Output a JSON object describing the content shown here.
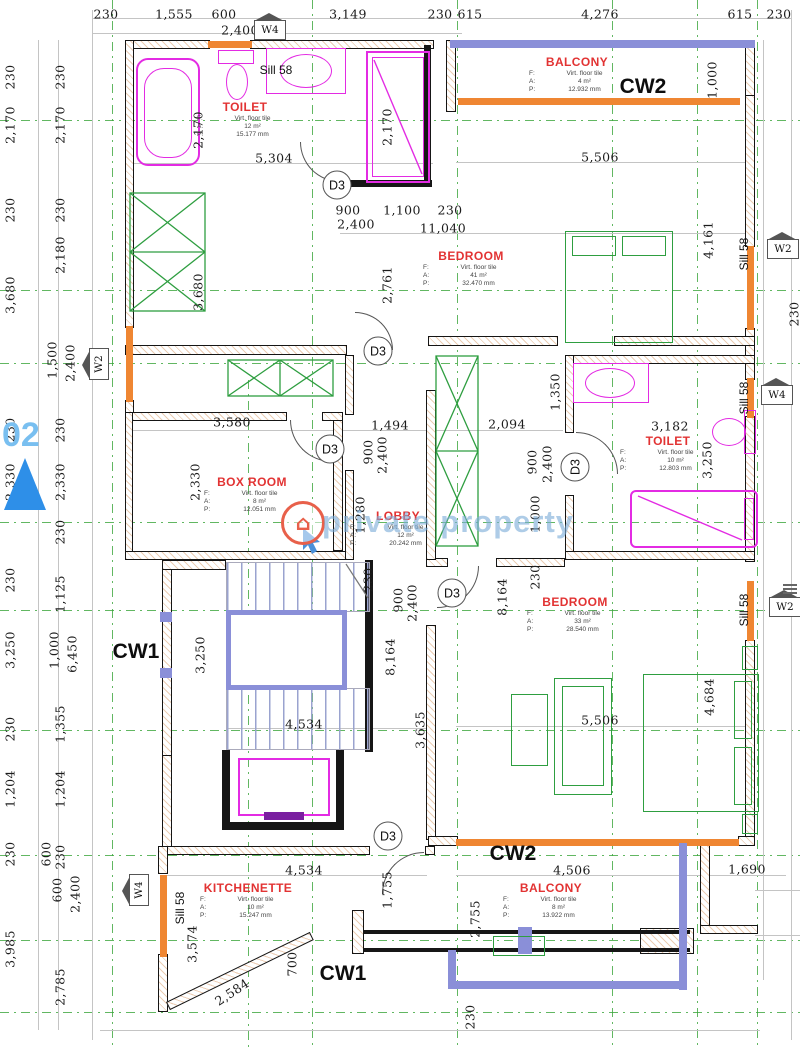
{
  "title": "Floor plan - Level 02",
  "watermark": {
    "brand": "private property",
    "logo": "house-icon"
  },
  "level_marker": {
    "label": "02"
  },
  "room_row_labels": {
    "f": "F:",
    "a": "A:",
    "p": "P:"
  },
  "rooms": [
    {
      "name": "TOILET",
      "x": 245,
      "y": 97,
      "f": "Virt. floor tile",
      "a": "12 m²",
      "p": "15.177 mm"
    },
    {
      "name": "BALCONY",
      "x": 577,
      "y": 52,
      "f": "Virt. floor tile",
      "a": "4 m²",
      "p": "12.932 mm"
    },
    {
      "name": "BEDROOM",
      "x": 471,
      "y": 246,
      "f": "Virt. floor tile",
      "a": "41 m²",
      "p": "32.470 mm"
    },
    {
      "name": "BOX ROOM",
      "x": 252,
      "y": 472,
      "f": "Virt. floor tile",
      "a": "8 m²",
      "p": "12.051 mm"
    },
    {
      "name": "LOBBY",
      "x": 398,
      "y": 506,
      "f": "Virt. floor tile",
      "a": "12 m²",
      "p": "20.242 mm"
    },
    {
      "name": "TOILET",
      "x": 668,
      "y": 431,
      "f": "Virt. floor tile",
      "a": "10 m²",
      "p": "12.803 mm"
    },
    {
      "name": "BEDROOM",
      "x": 575,
      "y": 592,
      "f": "Virt. floor tile",
      "a": "33 m²",
      "p": "28.540 mm"
    },
    {
      "name": "KITCHENETTE",
      "x": 248,
      "y": 878,
      "f": "Virt. floor tile",
      "a": "10 m²",
      "p": "15.247 mm"
    },
    {
      "name": "BALCONY",
      "x": 551,
      "y": 878,
      "f": "Virt. floor tile",
      "a": "8 m²",
      "p": "13.922 mm"
    }
  ],
  "cw_labels": [
    {
      "t": "CW1",
      "x": 136,
      "y": 652
    },
    {
      "t": "CW1",
      "x": 343,
      "y": 974
    },
    {
      "t": "CW2",
      "x": 643,
      "y": 87
    },
    {
      "t": "CW2",
      "x": 513,
      "y": 854
    }
  ],
  "door_label": "D3",
  "doors": [
    [
      337,
      185,
      0
    ],
    [
      378,
      351,
      0
    ],
    [
      330,
      449,
      0
    ],
    [
      575,
      467,
      -90
    ],
    [
      452,
      593,
      0
    ],
    [
      388,
      836,
      0
    ]
  ],
  "sill_label": "Sill 58",
  "sills": [
    [
      276,
      70,
      0
    ],
    [
      744,
      254,
      -90
    ],
    [
      744,
      398,
      -90
    ],
    [
      744,
      610,
      -90
    ],
    [
      180,
      908,
      -90
    ]
  ],
  "window_tags": [
    {
      "t": "W4",
      "x": 270,
      "y": 30,
      "r": 0
    },
    {
      "t": "W2",
      "x": 99,
      "y": 364,
      "r": -90
    },
    {
      "t": "W2",
      "x": 783,
      "y": 249,
      "r": 0
    },
    {
      "t": "W4",
      "x": 777,
      "y": 395,
      "r": 0
    },
    {
      "t": "W2",
      "x": 785,
      "y": 607,
      "r": 0
    },
    {
      "t": "W4",
      "x": 139,
      "y": 890,
      "r": -90
    }
  ],
  "dims": [
    [
      "230",
      106,
      14,
      0
    ],
    [
      "1,555",
      174,
      14,
      0
    ],
    [
      "600",
      224,
      14,
      0
    ],
    [
      "2,400",
      240,
      30,
      0
    ],
    [
      "3,149",
      348,
      14,
      0
    ],
    [
      "230",
      440,
      14,
      0
    ],
    [
      "615",
      470,
      14,
      0
    ],
    [
      "4,276",
      600,
      14,
      0
    ],
    [
      "615",
      740,
      14,
      0
    ],
    [
      "230",
      779,
      14,
      0
    ],
    [
      "230",
      10,
      77,
      -90
    ],
    [
      "230",
      60,
      77,
      -90
    ],
    [
      "2,170",
      10,
      125,
      -90
    ],
    [
      "2,170",
      60,
      125,
      -90
    ],
    [
      "230",
      10,
      210,
      -90
    ],
    [
      "230",
      60,
      210,
      -90
    ],
    [
      "3,680",
      10,
      295,
      -90
    ],
    [
      "2,180",
      60,
      255,
      -90
    ],
    [
      "1,500",
      52,
      360,
      -90
    ],
    [
      "2,400",
      70,
      363,
      -90
    ],
    [
      "230",
      10,
      430,
      -90
    ],
    [
      "230",
      60,
      430,
      -90
    ],
    [
      "2,330",
      10,
      482,
      -90
    ],
    [
      "2,330",
      60,
      482,
      -90
    ],
    [
      "230",
      60,
      532,
      -90
    ],
    [
      "230",
      10,
      580,
      -90
    ],
    [
      "1,125",
      60,
      594,
      -90
    ],
    [
      "3,250",
      10,
      650,
      -90
    ],
    [
      "1,000",
      54,
      650,
      -90
    ],
    [
      "6,450",
      72,
      654,
      -90
    ],
    [
      "230",
      10,
      729,
      -90
    ],
    [
      "1,355",
      60,
      724,
      -90
    ],
    [
      "1,204",
      10,
      789,
      -90
    ],
    [
      "1,204",
      60,
      789,
      -90
    ],
    [
      "230",
      10,
      854,
      -90
    ],
    [
      "600",
      46,
      854,
      -90
    ],
    [
      "230",
      60,
      857,
      -90
    ],
    [
      "600",
      57,
      890,
      -90
    ],
    [
      "2,400",
      75,
      894,
      -90
    ],
    [
      "3,985",
      10,
      949,
      -90
    ],
    [
      "2,785",
      60,
      987,
      -90
    ],
    [
      "1,000",
      712,
      80,
      -90
    ],
    [
      "4,161",
      708,
      240,
      -90
    ],
    [
      "230",
      794,
      314,
      -90
    ],
    [
      "2,170",
      198,
      130,
      -90
    ],
    [
      "2,170",
      387,
      127,
      -90
    ],
    [
      "5,304",
      274,
      158,
      0
    ],
    [
      "900",
      348,
      210,
      0
    ],
    [
      "2,400",
      356,
      224,
      0
    ],
    [
      "1,100",
      402,
      210,
      0
    ],
    [
      "230",
      450,
      210,
      0
    ],
    [
      "11,040",
      443,
      228,
      0
    ],
    [
      "2,761",
      387,
      285,
      -90
    ],
    [
      "3,680",
      198,
      292,
      -90
    ],
    [
      "5,506",
      600,
      157,
      0
    ],
    [
      "3,580",
      232,
      422,
      0
    ],
    [
      "1,494",
      390,
      425,
      0
    ],
    [
      "2,094",
      507,
      424,
      0
    ],
    [
      "2,330",
      195,
      482,
      -90
    ],
    [
      "900",
      368,
      452,
      -90
    ],
    [
      "2,400",
      382,
      455,
      -90
    ],
    [
      "1,280",
      360,
      515,
      -90
    ],
    [
      "1,350",
      555,
      392,
      -90
    ],
    [
      "900",
      532,
      462,
      -90
    ],
    [
      "2,400",
      547,
      464,
      -90
    ],
    [
      "1,000",
      535,
      514,
      -90
    ],
    [
      "230",
      535,
      577,
      -90
    ],
    [
      "230",
      368,
      580,
      -90
    ],
    [
      "3,250",
      707,
      460,
      -90
    ],
    [
      "3,182",
      670,
      426,
      0
    ],
    [
      "900",
      398,
      600,
      -90
    ],
    [
      "2,400",
      412,
      603,
      -90
    ],
    [
      "8,164",
      390,
      657,
      -90
    ],
    [
      "8,164",
      502,
      597,
      -90
    ],
    [
      "3,250",
      200,
      655,
      -90
    ],
    [
      "4,534",
      304,
      724,
      0
    ],
    [
      "3,635",
      420,
      730,
      -90
    ],
    [
      "5,506",
      600,
      720,
      0
    ],
    [
      "4,684",
      709,
      697,
      -90
    ],
    [
      "4,534",
      304,
      870,
      0
    ],
    [
      "1,755",
      387,
      890,
      -90
    ],
    [
      "3,574",
      192,
      944,
      -90
    ],
    [
      "700",
      292,
      964,
      -90
    ],
    [
      "2,584",
      232,
      992,
      -33
    ],
    [
      "4,506",
      572,
      870,
      0
    ],
    [
      "2,755",
      475,
      919,
      -90
    ],
    [
      "1,690",
      747,
      869,
      0
    ],
    [
      "230",
      470,
      1017,
      -90
    ]
  ],
  "colors": {
    "wall": "#151515",
    "window": "#ef8632",
    "rail": "#8a8fd8",
    "fixture": "#e32be3",
    "furniture": "#2e9e40",
    "room_label": "#e23333",
    "grid": "#3aa53a",
    "watermark": "#7dacd8",
    "logo": "#e8604a"
  }
}
